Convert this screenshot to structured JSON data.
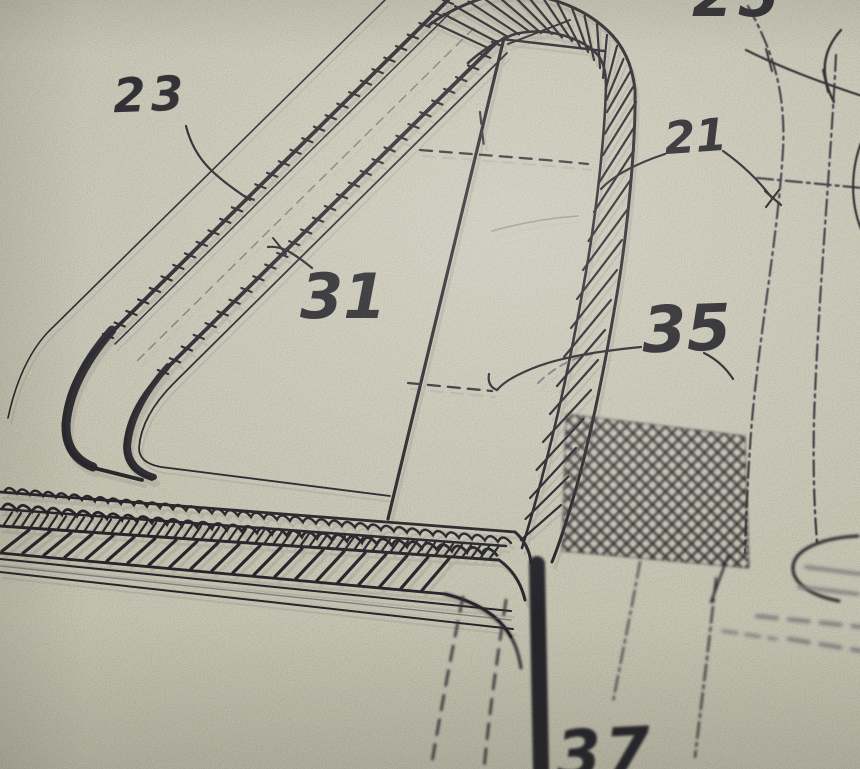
{
  "figure": {
    "labels": {
      "top_partial": "25",
      "upper_left": "23",
      "inner": "31",
      "right": "21",
      "mid_right": "35",
      "bottom": "37"
    },
    "colors": {
      "paper": "#e8e5d2",
      "ink": "#1a1a24",
      "phantom": "#32323e",
      "faint": "#8d8d92"
    }
  }
}
